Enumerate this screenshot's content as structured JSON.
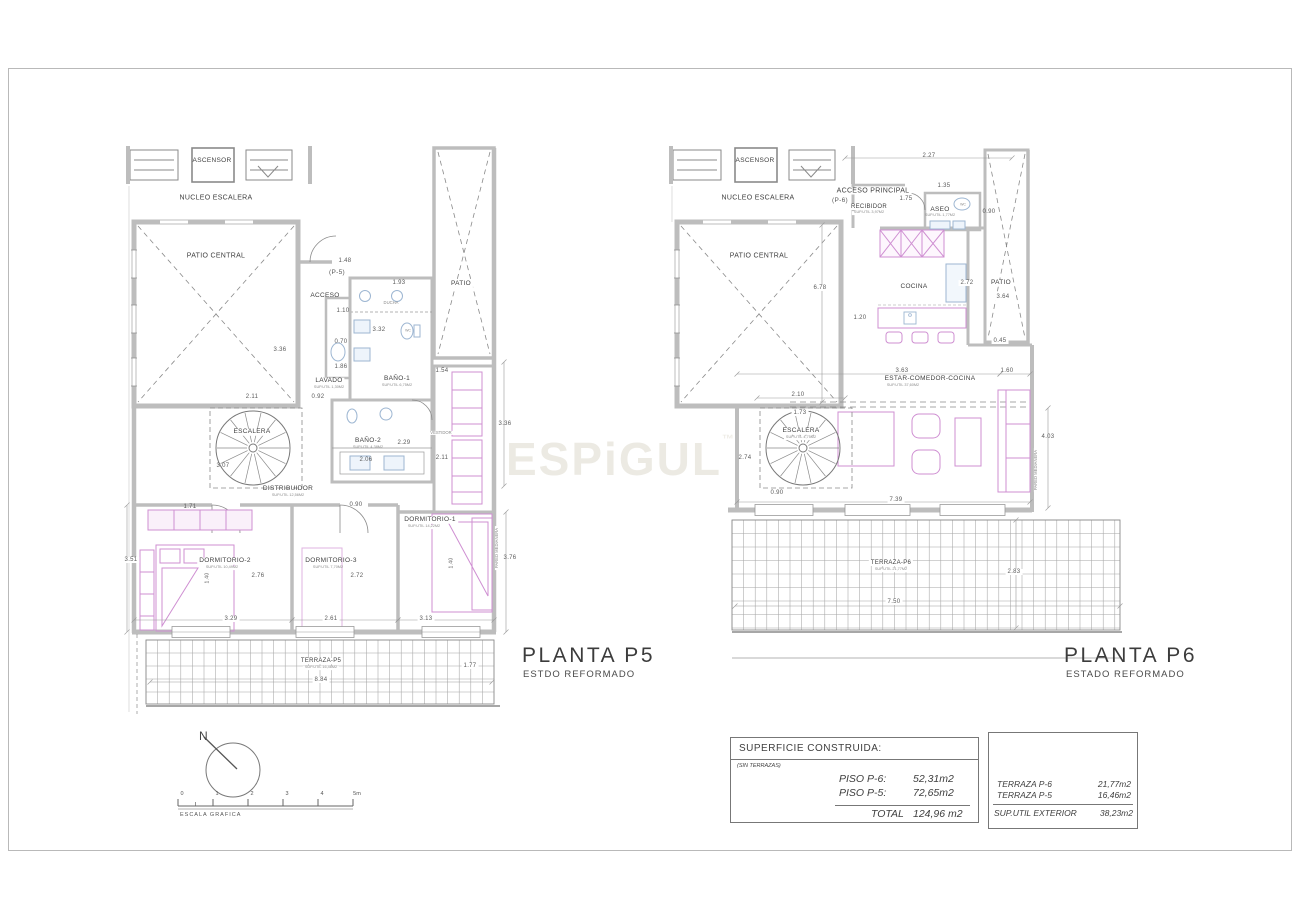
{
  "watermark": {
    "text": "ESPiGUL",
    "mark": "™"
  },
  "plans": [
    {
      "id": "p5",
      "title": "PLANTA P5",
      "subtitle": "ESTDO REFORMADO",
      "labels": [
        {
          "t": "ASCENSOR",
          "x": 212,
          "y": 161,
          "s": 6.5,
          "k": "room"
        },
        {
          "t": "NUCLEO ESCALERA",
          "x": 216,
          "y": 198,
          "s": 7,
          "k": "room"
        },
        {
          "t": "PATIO CENTRAL",
          "x": 216,
          "y": 256,
          "s": 7,
          "k": "room"
        },
        {
          "t": "1.48",
          "x": 345,
          "y": 261,
          "s": 6
        },
        {
          "t": "(P-5)",
          "x": 337,
          "y": 273,
          "s": 6.5
        },
        {
          "t": "1.93",
          "x": 399,
          "y": 283,
          "s": 6
        },
        {
          "t": "ACCESO",
          "x": 325,
          "y": 296,
          "s": 6.5,
          "k": "room"
        },
        {
          "t": "DUCHA",
          "x": 391,
          "y": 303,
          "s": 4.2,
          "k": "sub"
        },
        {
          "t": "1.10",
          "x": 343,
          "y": 311,
          "s": 6
        },
        {
          "t": "3.32",
          "x": 379,
          "y": 330,
          "s": 6
        },
        {
          "t": "0.70",
          "x": 341,
          "y": 342,
          "s": 6
        },
        {
          "t": "1.86",
          "x": 341,
          "y": 367,
          "s": 6
        },
        {
          "t": "3.36",
          "x": 280,
          "y": 350,
          "s": 6
        },
        {
          "t": "WC",
          "x": 408,
          "y": 331,
          "s": 3.5,
          "k": "sub"
        },
        {
          "t": "BAÑO-1",
          "x": 397,
          "y": 379,
          "s": 6.5,
          "k": "room",
          "bg": 1
        },
        {
          "t": "SUP.UTIL 6,75M2",
          "x": 397,
          "y": 386,
          "s": 3.8,
          "k": "sub",
          "bg": 1
        },
        {
          "t": "LAVADO",
          "x": 329,
          "y": 381,
          "s": 6.5,
          "k": "room",
          "bg": 1
        },
        {
          "t": "SUP.UTIL 1,30M2",
          "x": 329,
          "y": 388,
          "s": 3.8,
          "k": "sub",
          "bg": 1
        },
        {
          "t": "2.11",
          "x": 252,
          "y": 397,
          "s": 6
        },
        {
          "t": "0.92",
          "x": 318,
          "y": 397,
          "s": 6
        },
        {
          "t": "1.54",
          "x": 442,
          "y": 371,
          "s": 6
        },
        {
          "t": "PATIO",
          "x": 461,
          "y": 284,
          "s": 6.5,
          "k": "room",
          "bg": 1
        },
        {
          "t": "ESCALERA",
          "x": 252,
          "y": 432,
          "s": 6.5,
          "k": "room",
          "bg": 1
        },
        {
          "t": "3.07",
          "x": 223,
          "y": 466,
          "s": 6
        },
        {
          "t": "VESTIDOR",
          "x": 441,
          "y": 433,
          "s": 4.2,
          "k": "sub",
          "bg": 1
        },
        {
          "t": "BAÑO-2",
          "x": 368,
          "y": 441,
          "s": 6.5,
          "k": "room"
        },
        {
          "t": "SUP.UTIL 4,38M2",
          "x": 368,
          "y": 448,
          "s": 3.8,
          "k": "sub"
        },
        {
          "t": "2.29",
          "x": 404,
          "y": 443,
          "s": 6
        },
        {
          "t": "2.06",
          "x": 366,
          "y": 460,
          "s": 6
        },
        {
          "t": "2.11",
          "x": 442,
          "y": 458,
          "s": 6
        },
        {
          "t": "3.36",
          "x": 505,
          "y": 424,
          "s": 6
        },
        {
          "t": "DISTRIBUIDOR",
          "x": 288,
          "y": 489,
          "s": 6.5,
          "k": "room"
        },
        {
          "t": "SUP.UTIL 12,56M2",
          "x": 288,
          "y": 496,
          "s": 3.8,
          "k": "sub"
        },
        {
          "t": "0.90",
          "x": 356,
          "y": 505,
          "s": 6
        },
        {
          "t": "1.71",
          "x": 190,
          "y": 507,
          "s": 6
        },
        {
          "t": "DORMITORIO-1",
          "x": 430,
          "y": 520,
          "s": 6.5,
          "k": "room",
          "bg": 1
        },
        {
          "t": "SUP.UTIL 14,22M2",
          "x": 424,
          "y": 527,
          "s": 3.8,
          "k": "sub",
          "bg": 1
        },
        {
          "t": "3.51",
          "x": 131,
          "y": 560,
          "s": 6,
          "bg": 1
        },
        {
          "t": "DORMITORIO-2",
          "x": 225,
          "y": 561,
          "s": 6.5,
          "k": "room",
          "bg": 1
        },
        {
          "t": "SUP.UTIL 10,49M2",
          "x": 222,
          "y": 568,
          "s": 3.8,
          "k": "sub",
          "bg": 1
        },
        {
          "t": "DORMITORIO-3",
          "x": 331,
          "y": 561,
          "s": 6.5,
          "k": "room"
        },
        {
          "t": "SUP.UTIL 7,70M2",
          "x": 328,
          "y": 568,
          "s": 3.8,
          "k": "sub"
        },
        {
          "t": "2.76",
          "x": 258,
          "y": 576,
          "s": 6
        },
        {
          "t": "2.72",
          "x": 357,
          "y": 576,
          "s": 6
        },
        {
          "t": "1.40",
          "x": 208,
          "y": 578,
          "s": 5,
          "r": -90
        },
        {
          "t": "1.40",
          "x": 452,
          "y": 563,
          "s": 5,
          "r": -90,
          "bg": 1
        },
        {
          "t": "3.29",
          "x": 231,
          "y": 619,
          "s": 6,
          "bg": 1
        },
        {
          "t": "2.61",
          "x": 331,
          "y": 619,
          "s": 6,
          "bg": 1
        },
        {
          "t": "3.13",
          "x": 426,
          "y": 619,
          "s": 6,
          "bg": 1
        },
        {
          "t": "PARED MEDIANERA",
          "x": 497,
          "y": 548,
          "s": 4.2,
          "r": -90,
          "k": "sub",
          "bg": 1
        },
        {
          "t": "3.76",
          "x": 510,
          "y": 558,
          "s": 6
        },
        {
          "t": "TERRAZA-P5",
          "x": 321,
          "y": 661,
          "s": 6,
          "k": "room",
          "bg": 1
        },
        {
          "t": "SUP.UTIL 16,46M2",
          "x": 321,
          "y": 668,
          "s": 3.8,
          "k": "sub",
          "bg": 1
        },
        {
          "t": "8.84",
          "x": 321,
          "y": 680,
          "s": 6,
          "bg": 1
        },
        {
          "t": "1.77",
          "x": 470,
          "y": 666,
          "s": 6,
          "bg": 1
        }
      ]
    },
    {
      "id": "p6",
      "title": "PLANTA P6",
      "subtitle": "ESTADO REFORMADO",
      "labels": [
        {
          "t": "ASCENSOR",
          "x": 755,
          "y": 161,
          "s": 6.5,
          "k": "room"
        },
        {
          "t": "NUCLEO ESCALERA",
          "x": 758,
          "y": 198,
          "s": 7,
          "k": "room"
        },
        {
          "t": "2.27",
          "x": 929,
          "y": 156,
          "s": 6
        },
        {
          "t": "ACCESO PRINCIPAL",
          "x": 873,
          "y": 191,
          "s": 7,
          "k": "room",
          "bg": 1
        },
        {
          "t": "(P-6)",
          "x": 840,
          "y": 201,
          "s": 6.5
        },
        {
          "t": "RECIBIDOR",
          "x": 869,
          "y": 207,
          "s": 6,
          "k": "room",
          "bg": 1
        },
        {
          "t": "SUP.UTIL 3,97M2",
          "x": 869,
          "y": 213,
          "s": 3.8,
          "k": "sub",
          "bg": 1
        },
        {
          "t": "1.35",
          "x": 944,
          "y": 186,
          "s": 6
        },
        {
          "t": "1.75",
          "x": 906,
          "y": 199,
          "s": 6
        },
        {
          "t": "ASEO",
          "x": 940,
          "y": 210,
          "s": 6.5,
          "k": "room"
        },
        {
          "t": "SUP.UTIL 1,77M2",
          "x": 940,
          "y": 216,
          "s": 3.8,
          "k": "sub"
        },
        {
          "t": "WC",
          "x": 963,
          "y": 205,
          "s": 3.5,
          "k": "sub"
        },
        {
          "t": "0.90",
          "x": 989,
          "y": 212,
          "s": 6
        },
        {
          "t": "PATIO CENTRAL",
          "x": 759,
          "y": 256,
          "s": 7,
          "k": "room"
        },
        {
          "t": "6.78",
          "x": 820,
          "y": 288,
          "s": 6,
          "bg": 1
        },
        {
          "t": "COCINA",
          "x": 914,
          "y": 287,
          "s": 6.5,
          "k": "room"
        },
        {
          "t": "2.72",
          "x": 967,
          "y": 283,
          "s": 6,
          "bg": 1
        },
        {
          "t": "PATIO",
          "x": 1001,
          "y": 283,
          "s": 6.5,
          "k": "room",
          "bg": 1
        },
        {
          "t": "3.64",
          "x": 1003,
          "y": 297,
          "s": 6,
          "bg": 1
        },
        {
          "t": "1.20",
          "x": 860,
          "y": 318,
          "s": 6
        },
        {
          "t": "0.45",
          "x": 1000,
          "y": 341,
          "s": 6,
          "bg": 1
        },
        {
          "t": "3.63",
          "x": 902,
          "y": 371,
          "s": 6
        },
        {
          "t": "1.60",
          "x": 1007,
          "y": 371,
          "s": 6
        },
        {
          "t": "ESTAR-COMEDOR-COCINA",
          "x": 930,
          "y": 379,
          "s": 6.5,
          "k": "room"
        },
        {
          "t": "SUP.UTIL 37,60M2",
          "x": 903,
          "y": 386,
          "s": 3.8,
          "k": "sub"
        },
        {
          "t": "2.10",
          "x": 798,
          "y": 395,
          "s": 6
        },
        {
          "t": "1.73",
          "x": 800,
          "y": 413,
          "s": 6,
          "bg": 1
        },
        {
          "t": "ESCALERA",
          "x": 801,
          "y": 431,
          "s": 6.5,
          "k": "room",
          "bg": 1
        },
        {
          "t": "SUP.UTIL 4,75M2",
          "x": 801,
          "y": 438,
          "s": 3.8,
          "k": "sub",
          "bg": 1
        },
        {
          "t": "2.74",
          "x": 745,
          "y": 458,
          "s": 6
        },
        {
          "t": "0.90",
          "x": 777,
          "y": 493,
          "s": 6
        },
        {
          "t": "7.39",
          "x": 896,
          "y": 500,
          "s": 6,
          "bg": 1
        },
        {
          "t": "4.03",
          "x": 1048,
          "y": 437,
          "s": 6
        },
        {
          "t": "PARED MEDIANERA",
          "x": 1036,
          "y": 470,
          "s": 4.2,
          "r": -90,
          "k": "sub",
          "bg": 1
        },
        {
          "t": "TERRAZA-P6",
          "x": 891,
          "y": 563,
          "s": 6,
          "k": "room",
          "bg": 1
        },
        {
          "t": "SUP.UTIL 21,77M2",
          "x": 891,
          "y": 570,
          "s": 3.8,
          "k": "sub",
          "bg": 1
        },
        {
          "t": "2.83",
          "x": 1014,
          "y": 572,
          "s": 6,
          "bg": 1
        },
        {
          "t": "7.50",
          "x": 894,
          "y": 602,
          "s": 6,
          "bg": 1
        }
      ]
    }
  ],
  "compass": {
    "north_label": "N"
  },
  "scale_bar": {
    "ticks": [
      "0",
      "1",
      "2",
      "3",
      "4",
      "5m"
    ],
    "label": "ESCALA GRAFICA"
  },
  "tables": {
    "built": {
      "title": "SUPERFICIE CONSTRUIDA:",
      "note": "(SIN TERRAZAS)",
      "rows": [
        {
          "label": "PISO P-6:",
          "value": "52,31m2"
        },
        {
          "label": "PISO P-5:",
          "value": "72,65m2"
        }
      ],
      "total_label": "TOTAL",
      "total_value": "124,96 m2"
    },
    "exterior": {
      "rows": [
        {
          "label": "TERRAZA P-6",
          "value": "21,77m2"
        },
        {
          "label": "TERRAZA P-5",
          "value": "16,46m2"
        }
      ],
      "total_label": "SUP.UTIL EXTERIOR",
      "total_value": "38,23m2"
    }
  },
  "colors": {
    "wall": "#bdbdbd",
    "line": "#787878",
    "furniture": "#cf8fd2",
    "fixture": "#9db6d2",
    "dim": "#9a9a9a"
  }
}
